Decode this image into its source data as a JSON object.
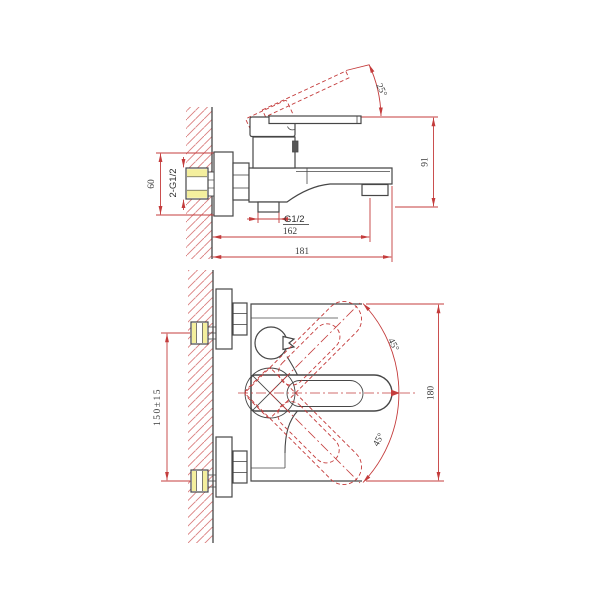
{
  "drawing": {
    "kind": "technical-drawing",
    "subject": "wall-mounted bath mixer faucet, two orthographic views with dimensions",
    "colors": {
      "line": "#464646",
      "dimension": "#c43c3c",
      "hatch": "#d97d7d",
      "highlight": "#f4ef9e",
      "background": "#ffffff"
    },
    "side_view": {
      "handle_angle_label": "25°",
      "flange_height_label": "60",
      "wall_connection_label": "2-G1/2",
      "outlet_thread_label": "G1/2",
      "spout_center_label": "162",
      "overall_depth_label": "181",
      "height_label": "91"
    },
    "front_view": {
      "swing_upper_label": "45°",
      "swing_lower_label": "45°",
      "connection_spacing_label": "150±15",
      "swing_envelope_label": "180"
    }
  }
}
